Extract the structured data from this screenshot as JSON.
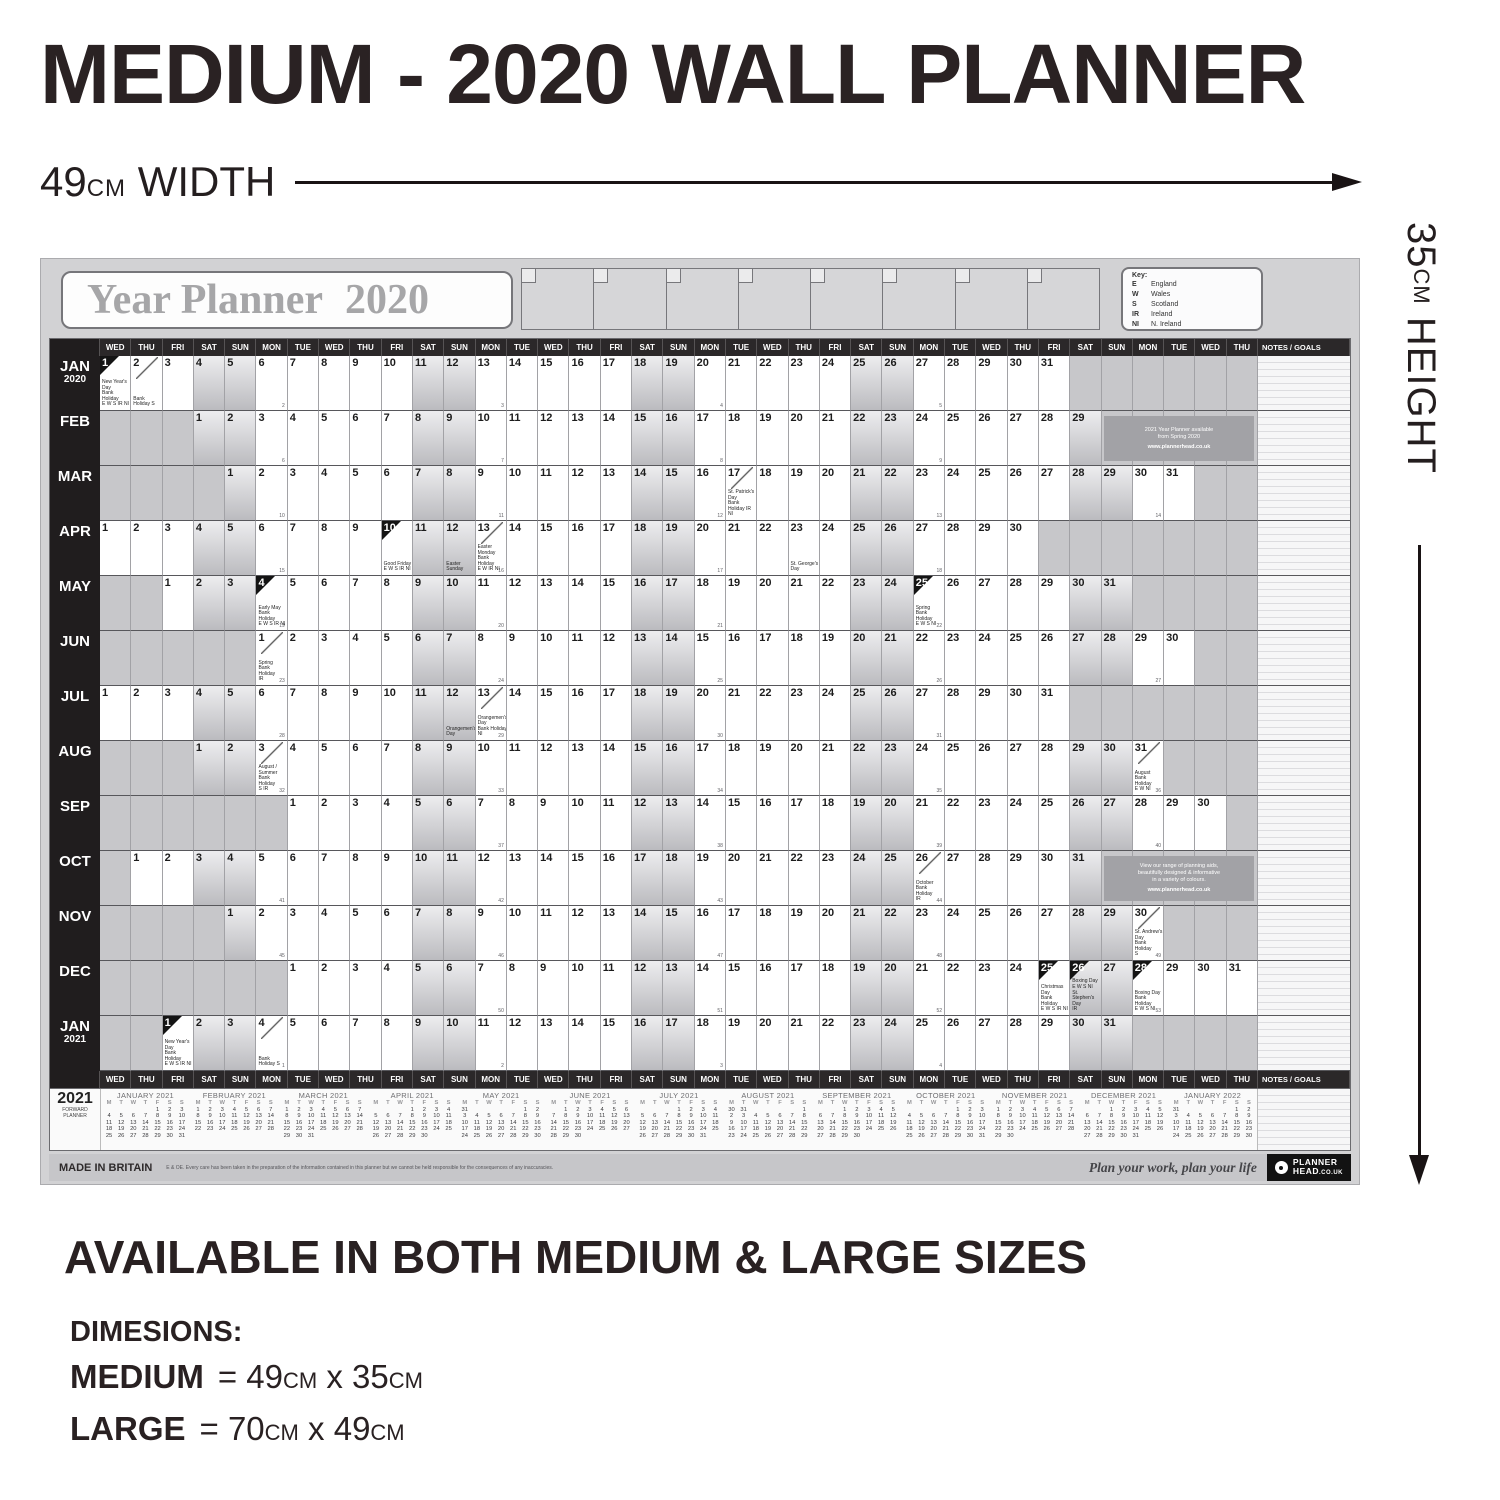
{
  "colors": {
    "ink_dark": "#2a2223",
    "header_bar": "#2b2829",
    "paper_gray": "#d2d2d4",
    "promo_gray": "#a2a2a6"
  },
  "page": {
    "title": "MEDIUM - 2020 WALL PLANNER",
    "width_label": {
      "value": "49",
      "unit": "cm",
      "word": "WIDTH"
    },
    "height_label": {
      "value": "35",
      "unit": "cm",
      "word": "HEIGHT"
    },
    "availability": "AVAILABLE IN BOTH MEDIUM & LARGE SIZES",
    "dimensions_heading": "DIMESIONS:",
    "dimension_rows": [
      {
        "name": "MEDIUM",
        "parts": [
          "= 49",
          "cm",
          " x 35",
          "cm"
        ]
      },
      {
        "name": "LARGE",
        "parts": [
          "= 70",
          "cm",
          " x 49",
          "cm"
        ]
      }
    ]
  },
  "planner": {
    "title": "Year Planner",
    "year": "2020",
    "key": {
      "heading": "Key:",
      "entries": [
        {
          "code": "E",
          "name": "England"
        },
        {
          "code": "W",
          "name": "Wales"
        },
        {
          "code": "S",
          "name": "Scotland"
        },
        {
          "code": "IR",
          "name": "Ireland"
        },
        {
          "code": "NI",
          "name": "N. Ireland"
        }
      ]
    },
    "notes_header": "NOTES / GOALS",
    "day_columns": [
      "WED",
      "THU",
      "FRI",
      "SAT",
      "SUN",
      "MON",
      "TUE",
      "WED",
      "THU",
      "FRI",
      "SAT",
      "SUN",
      "MON",
      "TUE",
      "WED",
      "THU",
      "FRI",
      "SAT",
      "SUN",
      "MON",
      "TUE",
      "WED",
      "THU",
      "FRI",
      "SAT",
      "SUN",
      "MON",
      "TUE",
      "WED",
      "THU",
      "FRI",
      "SAT",
      "SUN",
      "MON",
      "TUE",
      "WED",
      "THU"
    ],
    "months": [
      {
        "label": "JAN",
        "sub": "2020",
        "start": 0,
        "days": 31,
        "week1": 2,
        "holidays": [
          {
            "day": 1,
            "mark": "black",
            "note": [
              "New Year's Day",
              "Bank Holiday",
              "E W S IR NI"
            ]
          },
          {
            "day": 2,
            "mark": "slash",
            "note": [
              "Bank Holiday S"
            ]
          }
        ]
      },
      {
        "label": "FEB",
        "start": 3,
        "days": 29,
        "week1": 6,
        "holidays": []
      },
      {
        "label": "MAR",
        "start": 4,
        "days": 31,
        "week1": 10,
        "holidays": [
          {
            "day": 17,
            "mark": "slash",
            "note": [
              "St. Patrick's Day",
              "Bank Holiday IR NI"
            ]
          }
        ]
      },
      {
        "label": "APR",
        "start": 0,
        "days": 30,
        "week1": 15,
        "holidays": [
          {
            "day": 10,
            "mark": "black",
            "note": [
              "Good Friday",
              "E W S IR NI"
            ]
          },
          {
            "day": 12,
            "mark": "none",
            "note": [
              "Easter Sunday"
            ]
          },
          {
            "day": 13,
            "mark": "slash",
            "note": [
              "Easter Monday",
              "Bank Holiday",
              "E W IR NI"
            ]
          },
          {
            "day": 23,
            "mark": "none",
            "note": [
              "St. George's Day"
            ]
          }
        ]
      },
      {
        "label": "MAY",
        "start": 2,
        "days": 31,
        "week1": 19,
        "holidays": [
          {
            "day": 4,
            "mark": "black",
            "note": [
              "Early May",
              "Bank Holiday",
              "E W S IR NI"
            ]
          },
          {
            "day": 25,
            "mark": "black",
            "note": [
              "Spring",
              "Bank Holiday",
              "E W S NI"
            ]
          }
        ]
      },
      {
        "label": "JUN",
        "start": 5,
        "days": 30,
        "week1": 23,
        "holidays": [
          {
            "day": 1,
            "mark": "slash",
            "note": [
              "Spring",
              "Bank Holiday",
              "IR"
            ]
          }
        ]
      },
      {
        "label": "JUL",
        "start": 0,
        "days": 31,
        "week1": 28,
        "holidays": [
          {
            "day": 12,
            "mark": "none",
            "note": [
              "Orangemen's Day"
            ]
          },
          {
            "day": 13,
            "mark": "slash",
            "note": [
              "Orangemen's Day",
              "Bank Holiday",
              "NI"
            ]
          }
        ]
      },
      {
        "label": "AUG",
        "start": 3,
        "days": 31,
        "week1": 32,
        "holidays": [
          {
            "day": 3,
            "mark": "slash",
            "note": [
              "August / Summer",
              "Bank Holiday",
              "S IR"
            ]
          },
          {
            "day": 31,
            "mark": "slash",
            "note": [
              "August",
              "Bank Holiday",
              "E W NI"
            ]
          }
        ]
      },
      {
        "label": "SEP",
        "start": 6,
        "days": 30,
        "week1": 37,
        "holidays": []
      },
      {
        "label": "OCT",
        "start": 1,
        "days": 31,
        "week1": 41,
        "holidays": [
          {
            "day": 26,
            "mark": "slash",
            "note": [
              "October",
              "Bank Holiday",
              "IR"
            ]
          }
        ]
      },
      {
        "label": "NOV",
        "start": 4,
        "days": 30,
        "week1": 45,
        "holidays": [
          {
            "day": 30,
            "mark": "slash",
            "note": [
              "St. Andrew's Day",
              "Bank Holiday",
              "S"
            ]
          }
        ]
      },
      {
        "label": "DEC",
        "start": 6,
        "days": 31,
        "week1": 50,
        "holidays": [
          {
            "day": 25,
            "mark": "black",
            "note": [
              "Christmas Day",
              "Bank Holiday",
              "E W S IR NI"
            ]
          },
          {
            "day": 26,
            "mark": "black",
            "note": [
              "Boxing Day",
              "E W S NI",
              "St. Stephen's Day",
              "IR"
            ]
          },
          {
            "day": 28,
            "mark": "black",
            "note": [
              "Boxing Day",
              "Bank Holiday",
              "E W S NI"
            ]
          }
        ]
      },
      {
        "label": "JAN",
        "sub": "2021",
        "start": 2,
        "days": 31,
        "week1": 1,
        "holidays": [
          {
            "day": 1,
            "mark": "black",
            "note": [
              "New Year's Day",
              "Bank Holiday",
              "E W S IR NI"
            ]
          },
          {
            "day": 4,
            "mark": "slash",
            "note": [
              "Bank Holiday S"
            ]
          }
        ]
      }
    ],
    "promos": [
      {
        "row_index": 1,
        "lines": [
          "2021 Year Planner available",
          "from Spring 2020"
        ],
        "url": "www.plannerhead.co.uk"
      },
      {
        "row_index": 9,
        "lines": [
          "View our range of planning aids,",
          "beautifully designed & informative",
          "in a variety of colours."
        ],
        "url": "www.plannerhead.co.uk"
      }
    ],
    "forward_planner": {
      "year": "2021",
      "label_lines": [
        "FORWARD",
        "PLANNER"
      ],
      "day_header": [
        "M",
        "T",
        "W",
        "T",
        "F",
        "S",
        "S"
      ],
      "months": [
        {
          "name": "JANUARY 2021",
          "offset": 4,
          "days": 31
        },
        {
          "name": "FEBRUARY 2021",
          "offset": 0,
          "days": 28
        },
        {
          "name": "MARCH 2021",
          "offset": 0,
          "days": 31
        },
        {
          "name": "APRIL 2021",
          "offset": 3,
          "days": 30
        },
        {
          "name": "MAY 2021",
          "offset": 5,
          "days": 31
        },
        {
          "name": "JUNE 2021",
          "offset": 1,
          "days": 30
        },
        {
          "name": "JULY 2021",
          "offset": 3,
          "days": 31
        },
        {
          "name": "AUGUST 2021",
          "offset": 6,
          "days": 31
        },
        {
          "name": "SEPTEMBER 2021",
          "offset": 2,
          "days": 30
        },
        {
          "name": "OCTOBER 2021",
          "offset": 4,
          "days": 31
        },
        {
          "name": "NOVEMBER 2021",
          "offset": 0,
          "days": 30
        },
        {
          "name": "DECEMBER 2021",
          "offset": 2,
          "days": 31
        },
        {
          "name": "JANUARY 2022",
          "offset": 5,
          "days": 31
        }
      ]
    },
    "footer": {
      "made_in": "MADE IN BRITAIN",
      "disclaimer": "E & OE. Every care has been taken in the preparation of the information contained in this planner but we cannot be held responsible for the consequences of any inaccuracies.",
      "tagline": "Plan your work, plan your life",
      "logo": {
        "line1": "PLANNER",
        "line2": "HEAD",
        "line2_suffix": ".CO.UK"
      }
    }
  }
}
